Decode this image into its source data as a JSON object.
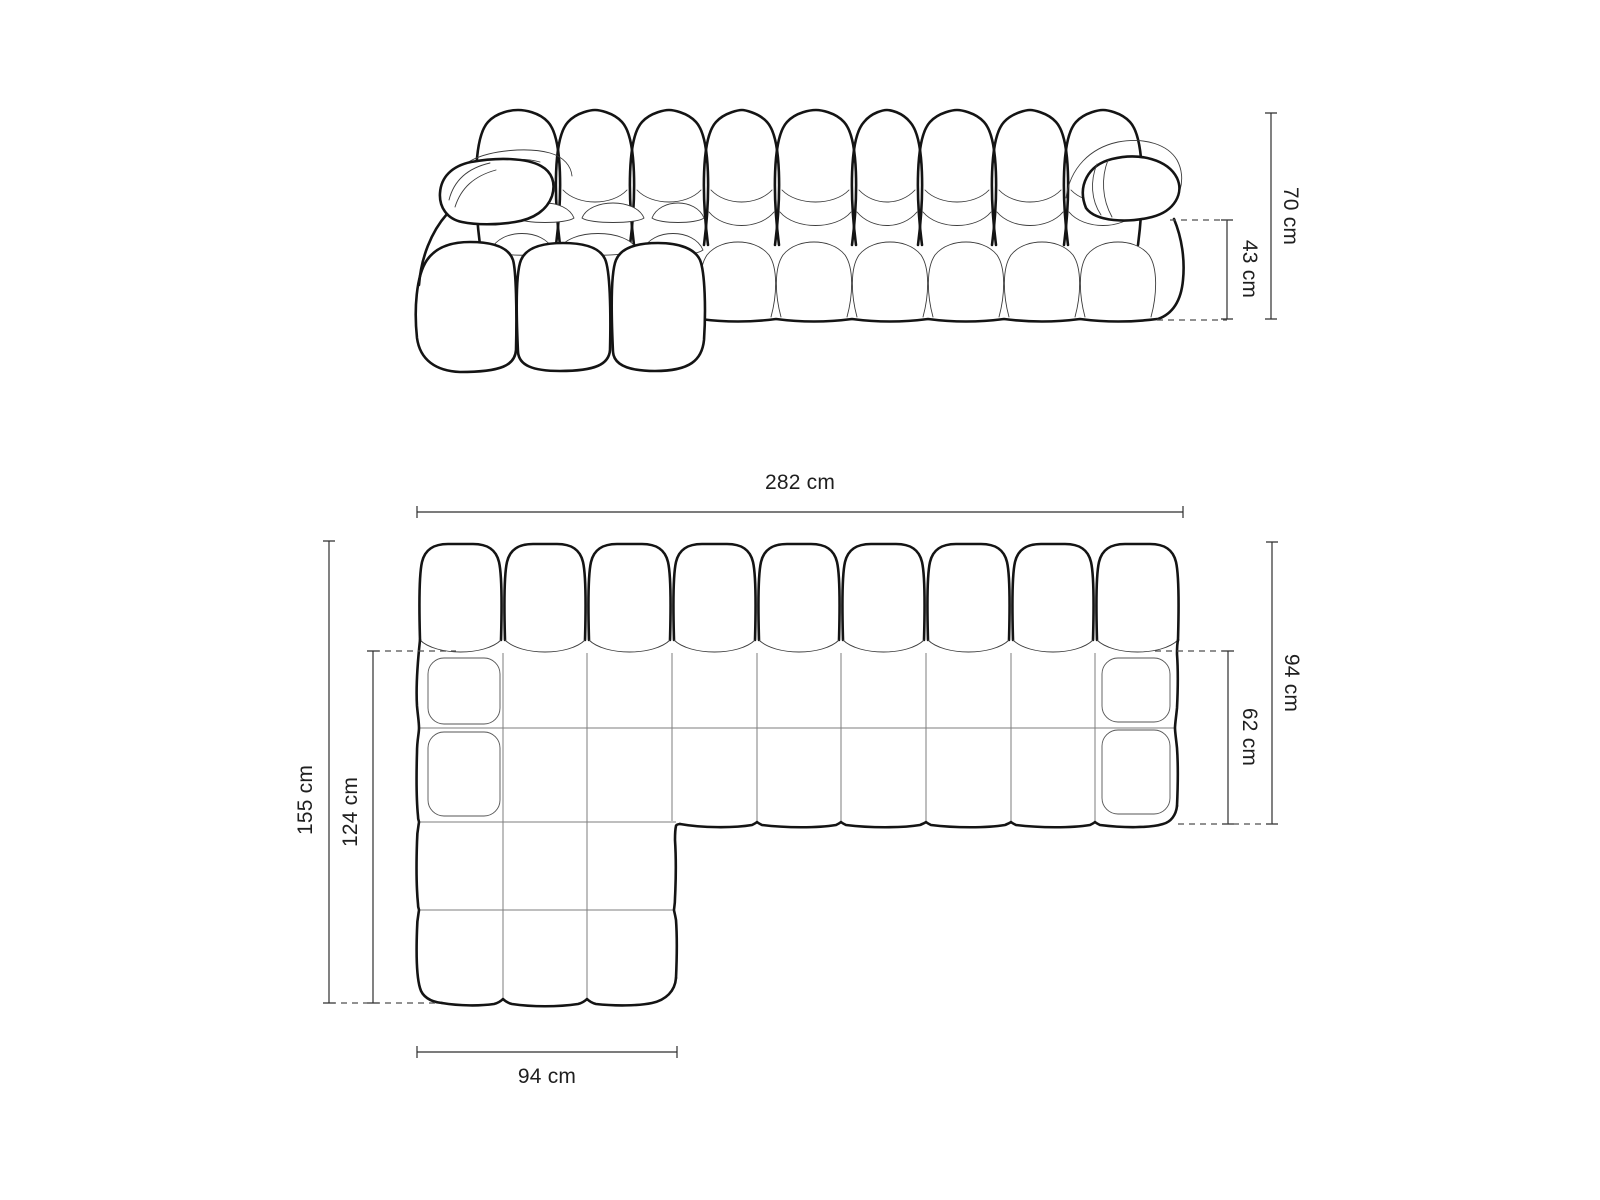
{
  "diagram_title": "Modular chaise sofa dimension drawing",
  "front_view": {
    "view_name": "front elevation",
    "dimensions": {
      "total_height": "70 cm",
      "seat_height": "43 cm"
    }
  },
  "top_view": {
    "view_name": "top plan",
    "dimensions": {
      "total_width": "282 cm",
      "total_depth": "155 cm",
      "chaise_depth": "124 cm",
      "chaise_width": "94 cm",
      "side_depth": "94 cm",
      "seat_depth": "62 cm"
    }
  },
  "colors": {
    "background": "#ffffff",
    "outline": "#141414",
    "detail_line": "#3c3c3c",
    "seam_line": "#7d7d7d",
    "dimension_line": "#2e2e2e",
    "dashed_line": "#4f4f4f",
    "label_text": "#1f1f1f"
  }
}
